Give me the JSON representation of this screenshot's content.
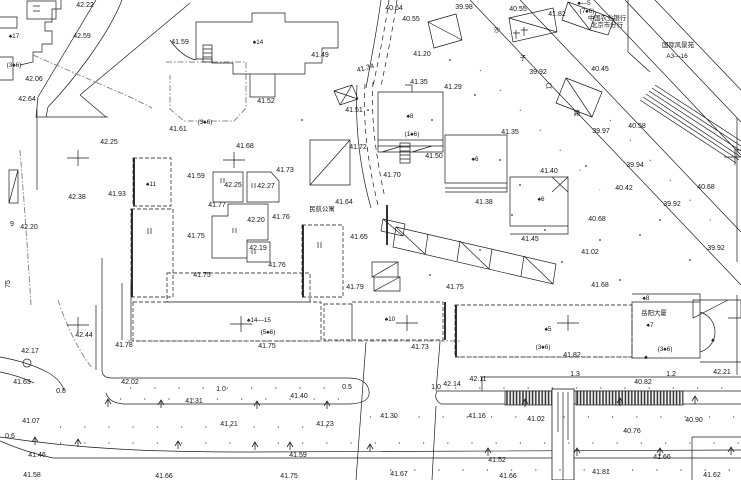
{
  "title": "沙子口路地区地形图 site plan",
  "colors": {
    "line": "#1c1c1c",
    "boundary": "#8a8a8a",
    "text": "#161616",
    "background": "#ffffff"
  },
  "labels": [
    {
      "t": "42.22",
      "x": 85,
      "y": 7,
      "c": "n"
    },
    {
      "t": "42.59",
      "x": 82,
      "y": 38,
      "c": "n"
    },
    {
      "t": "41.59",
      "x": 180,
      "y": 44,
      "c": "n"
    },
    {
      "t": "42.06",
      "x": 34,
      "y": 81,
      "c": "n"
    },
    {
      "t": "42.64",
      "x": 27,
      "y": 101,
      "c": "n"
    },
    {
      "t": "41.49",
      "x": 320,
      "y": 57,
      "c": "n"
    },
    {
      "t": "41.52",
      "x": 266,
      "y": 103,
      "c": "n"
    },
    {
      "t": "41.51",
      "x": 354,
      "y": 112,
      "c": "n"
    },
    {
      "t": "41.61",
      "x": 178,
      "y": 131,
      "c": "n"
    },
    {
      "t": "42.25",
      "x": 109,
      "y": 144,
      "c": "n"
    },
    {
      "t": "42.38",
      "x": 77,
      "y": 199,
      "c": "n"
    },
    {
      "t": "41.93",
      "x": 117,
      "y": 196,
      "c": "n"
    },
    {
      "t": "42.20",
      "x": 29,
      "y": 229,
      "c": "n"
    },
    {
      "t": "42.44",
      "x": 84,
      "y": 337,
      "c": "n"
    },
    {
      "t": "42.17",
      "x": 30,
      "y": 353,
      "c": "n"
    },
    {
      "t": "41.78",
      "x": 124,
      "y": 347,
      "c": "n"
    },
    {
      "t": "41.68",
      "x": 245,
      "y": 148,
      "c": "n"
    },
    {
      "t": "41.59",
      "x": 196,
      "y": 178,
      "c": "n"
    },
    {
      "t": "41.73",
      "x": 285,
      "y": 172,
      "c": "n"
    },
    {
      "t": "42.25",
      "x": 233,
      "y": 187,
      "c": "n"
    },
    {
      "t": "42.27",
      "x": 266,
      "y": 188,
      "c": "n"
    },
    {
      "t": "41.77",
      "x": 217,
      "y": 207,
      "c": "n"
    },
    {
      "t": "42.20",
      "x": 256,
      "y": 222,
      "c": "n"
    },
    {
      "t": "41.76",
      "x": 281,
      "y": 219,
      "c": "n"
    },
    {
      "t": "41.75",
      "x": 196,
      "y": 238,
      "c": "n"
    },
    {
      "t": "42.19",
      "x": 258,
      "y": 250,
      "c": "n"
    },
    {
      "t": "41.76",
      "x": 277,
      "y": 267,
      "c": "n"
    },
    {
      "t": "41.75",
      "x": 202,
      "y": 277,
      "c": "n"
    },
    {
      "t": "41.75",
      "x": 455,
      "y": 289,
      "c": "n"
    },
    {
      "t": "41.79",
      "x": 355,
      "y": 289,
      "c": "n"
    },
    {
      "t": "41.72",
      "x": 358,
      "y": 149,
      "c": "n"
    },
    {
      "t": "41.70",
      "x": 392,
      "y": 177,
      "c": "n"
    },
    {
      "t": "41.50",
      "x": 434,
      "y": 158,
      "c": "n"
    },
    {
      "t": "41.64",
      "x": 344,
      "y": 204,
      "c": "n"
    },
    {
      "t": "41.65",
      "x": 359,
      "y": 239,
      "c": "n"
    },
    {
      "t": "41.35",
      "x": 419,
      "y": 84,
      "c": "n"
    },
    {
      "t": "41.29",
      "x": 453,
      "y": 89,
      "c": "n"
    },
    {
      "t": "41.20",
      "x": 422,
      "y": 56,
      "c": "n"
    },
    {
      "t": "41.34",
      "x": 366,
      "y": 70,
      "c": "n",
      "r": -15
    },
    {
      "t": "40.64",
      "x": 394,
      "y": 10,
      "c": "n"
    },
    {
      "t": "40.55",
      "x": 411,
      "y": 21,
      "c": "n"
    },
    {
      "t": "39.98",
      "x": 464,
      "y": 9,
      "c": "n"
    },
    {
      "t": "40.55",
      "x": 518,
      "y": 11,
      "c": "n"
    },
    {
      "t": "41.82",
      "x": 557,
      "y": 16,
      "c": "n"
    },
    {
      "t": "39.92",
      "x": 538,
      "y": 74,
      "c": "n"
    },
    {
      "t": "40.45",
      "x": 600,
      "y": 71,
      "c": "n"
    },
    {
      "t": "39.94",
      "x": 635,
      "y": 167,
      "c": "n"
    },
    {
      "t": "40.42",
      "x": 624,
      "y": 190,
      "c": "n"
    },
    {
      "t": "40.68",
      "x": 706,
      "y": 189,
      "c": "n"
    },
    {
      "t": "39.92",
      "x": 672,
      "y": 206,
      "c": "n"
    },
    {
      "t": "40.68",
      "x": 597,
      "y": 221,
      "c": "n"
    },
    {
      "t": "39.92",
      "x": 716,
      "y": 250,
      "c": "n"
    },
    {
      "t": "41.02",
      "x": 590,
      "y": 254,
      "c": "n"
    },
    {
      "t": "41.68",
      "x": 600,
      "y": 287,
      "c": "n"
    },
    {
      "t": "40.58",
      "x": 637,
      "y": 128,
      "c": "n"
    },
    {
      "t": "39.97",
      "x": 601,
      "y": 133,
      "c": "n"
    },
    {
      "t": "41.35",
      "x": 510,
      "y": 134,
      "c": "n"
    },
    {
      "t": "41.40",
      "x": 549,
      "y": 173,
      "c": "n"
    },
    {
      "t": "41.38",
      "x": 484,
      "y": 204,
      "c": "n"
    },
    {
      "t": "41.45",
      "x": 530,
      "y": 241,
      "c": "n"
    },
    {
      "t": "41.75",
      "x": 267,
      "y": 348,
      "c": "n"
    },
    {
      "t": "41.73",
      "x": 420,
      "y": 349,
      "c": "n"
    },
    {
      "t": "41.82",
      "x": 572,
      "y": 357,
      "c": "n"
    },
    {
      "t": "42.21",
      "x": 722,
      "y": 374,
      "c": "n"
    },
    {
      "t": "40.82",
      "x": 643,
      "y": 384,
      "c": "n"
    },
    {
      "t": "41.02",
      "x": 536,
      "y": 421,
      "c": "n"
    },
    {
      "t": "40.90",
      "x": 694,
      "y": 422,
      "c": "n"
    },
    {
      "t": "40.76",
      "x": 632,
      "y": 433,
      "c": "n"
    },
    {
      "t": "41.21",
      "x": 229,
      "y": 426,
      "c": "n"
    },
    {
      "t": "41.23",
      "x": 325,
      "y": 426,
      "c": "n"
    },
    {
      "t": "41.31",
      "x": 194,
      "y": 403,
      "c": "n"
    },
    {
      "t": "41.40",
      "x": 299,
      "y": 398,
      "c": "n"
    },
    {
      "t": "42.02",
      "x": 130,
      "y": 384,
      "c": "n"
    },
    {
      "t": "42.14",
      "x": 452,
      "y": 386,
      "c": "n"
    },
    {
      "t": "42.11",
      "x": 478,
      "y": 381,
      "c": "n"
    },
    {
      "t": "41.30",
      "x": 389,
      "y": 418,
      "c": "n"
    },
    {
      "t": "41.16",
      "x": 477,
      "y": 418,
      "c": "n"
    },
    {
      "t": "41.63",
      "x": 22,
      "y": 384,
      "c": "n"
    },
    {
      "t": "41.07",
      "x": 31,
      "y": 423,
      "c": "n"
    },
    {
      "t": "41.46",
      "x": 37,
      "y": 457,
      "c": "n"
    },
    {
      "t": "41.59",
      "x": 298,
      "y": 457,
      "c": "n"
    },
    {
      "t": "41.66",
      "x": 662,
      "y": 459,
      "c": "n"
    },
    {
      "t": "41.52",
      "x": 497,
      "y": 462,
      "c": "n"
    },
    {
      "t": "41.58",
      "x": 32,
      "y": 477,
      "c": "n"
    },
    {
      "t": "41.66",
      "x": 164,
      "y": 478,
      "c": "n"
    },
    {
      "t": "41.75",
      "x": 289,
      "y": 478,
      "c": "n"
    },
    {
      "t": "41.67",
      "x": 399,
      "y": 476,
      "c": "n"
    },
    {
      "t": "41.66",
      "x": 508,
      "y": 478,
      "c": "n"
    },
    {
      "t": "41.81",
      "x": 601,
      "y": 474,
      "c": "n"
    },
    {
      "t": "41.62",
      "x": 712,
      "y": 477,
      "c": "n"
    },
    {
      "t": "0.8",
      "x": 61,
      "y": 393,
      "c": "n"
    },
    {
      "t": "1.0",
      "x": 221,
      "y": 391,
      "c": "n"
    },
    {
      "t": "0.5",
      "x": 347,
      "y": 389,
      "c": "n"
    },
    {
      "t": "1.0",
      "x": 436,
      "y": 389,
      "c": "n"
    },
    {
      "t": "1.3",
      "x": 575,
      "y": 376,
      "c": "n"
    },
    {
      "t": "1.2",
      "x": 671,
      "y": 376,
      "c": "n"
    },
    {
      "t": "9",
      "x": 12,
      "y": 226,
      "c": "n"
    },
    {
      "t": "75",
      "x": 10,
      "y": 284,
      "c": "n",
      "r": -90
    },
    {
      "t": "0.6",
      "x": 10,
      "y": 438,
      "c": "n"
    },
    {
      "t": "♠17",
      "x": 14,
      "y": 38,
      "c": "g"
    },
    {
      "t": "(3♠6)",
      "x": 14,
      "y": 67,
      "c": "g"
    },
    {
      "t": "♠14",
      "x": 258,
      "y": 44,
      "c": "g"
    },
    {
      "t": "(3♠6)",
      "x": 205,
      "y": 124,
      "c": "g"
    },
    {
      "t": "♠11",
      "x": 151,
      "y": 186,
      "c": "g"
    },
    {
      "t": "♠8",
      "x": 410,
      "y": 118,
      "c": "g"
    },
    {
      "t": "(1♠6)",
      "x": 412,
      "y": 136,
      "c": "g"
    },
    {
      "t": "♠6",
      "x": 475,
      "y": 161,
      "c": "g"
    },
    {
      "t": "♠6",
      "x": 541,
      "y": 201,
      "c": "g"
    },
    {
      "t": "♠—5",
      "x": 584,
      "y": 5,
      "c": "g"
    },
    {
      "t": "(7♠6)",
      "x": 587,
      "y": 13,
      "c": "g"
    },
    {
      "t": "♠14—15",
      "x": 259,
      "y": 322,
      "c": "g"
    },
    {
      "t": "(5♠6)",
      "x": 268,
      "y": 334,
      "c": "g"
    },
    {
      "t": "♠10",
      "x": 390,
      "y": 321,
      "c": "g"
    },
    {
      "t": "♠5",
      "x": 548,
      "y": 331,
      "c": "g"
    },
    {
      "t": "(3♠6)",
      "x": 543,
      "y": 349,
      "c": "g"
    },
    {
      "t": "(3♠6)",
      "x": 665,
      "y": 351,
      "c": "g"
    },
    {
      "t": "♠8",
      "x": 646,
      "y": 300,
      "c": "g"
    },
    {
      "t": "♠7",
      "x": 650,
      "y": 327,
      "c": "g"
    },
    {
      "t": "♠",
      "x": 646,
      "y": 359,
      "c": "g"
    },
    {
      "t": "♠",
      "x": 713,
      "y": 342,
      "c": "g"
    },
    {
      "t": "中国农业银行",
      "x": 607,
      "y": 20,
      "c": "cn"
    },
    {
      "t": "北京市分行",
      "x": 607,
      "y": 27,
      "c": "cn"
    },
    {
      "t": "国际风景苑",
      "x": 678,
      "y": 47,
      "c": "cn"
    },
    {
      "t": "A3—16",
      "x": 677,
      "y": 58,
      "c": "cn"
    },
    {
      "t": "沙",
      "x": 497,
      "y": 32,
      "c": "cn"
    },
    {
      "t": "子",
      "x": 523,
      "y": 60,
      "c": "cn"
    },
    {
      "t": "口",
      "x": 549,
      "y": 88,
      "c": "cn"
    },
    {
      "t": "路",
      "x": 577,
      "y": 115,
      "c": "cn"
    },
    {
      "t": "民航公寓",
      "x": 322,
      "y": 211,
      "c": "cn"
    },
    {
      "t": "岳阳大厦",
      "x": 654,
      "y": 315,
      "c": "cn"
    }
  ],
  "markers": {
    "crosses": [
      {
        "x": 78,
        "y": 158
      },
      {
        "x": 234,
        "y": 160
      },
      {
        "x": 735,
        "y": 157
      },
      {
        "x": 78,
        "y": 325
      },
      {
        "x": 241,
        "y": 324
      },
      {
        "x": 407,
        "y": 323
      },
      {
        "x": 568,
        "y": 323
      }
    ],
    "trees": [
      {
        "x": 108,
        "y": 403
      },
      {
        "x": 161,
        "y": 404
      },
      {
        "x": 257,
        "y": 405
      },
      {
        "x": 327,
        "y": 405
      },
      {
        "x": 525,
        "y": 403
      },
      {
        "x": 620,
        "y": 402
      },
      {
        "x": 695,
        "y": 400
      },
      {
        "x": 35,
        "y": 441
      },
      {
        "x": 78,
        "y": 443
      },
      {
        "x": 178,
        "y": 445
      },
      {
        "x": 255,
        "y": 446
      },
      {
        "x": 290,
        "y": 446
      },
      {
        "x": 370,
        "y": 448
      },
      {
        "x": 488,
        "y": 452
      },
      {
        "x": 577,
        "y": 452
      },
      {
        "x": 660,
        "y": 452
      },
      {
        "x": 731,
        "y": 451
      }
    ],
    "dots": [
      {
        "x": 450,
        "y": 60
      },
      {
        "x": 475,
        "y": 95
      },
      {
        "x": 432,
        "y": 120
      },
      {
        "x": 500,
        "y": 160
      },
      {
        "x": 520,
        "y": 185
      },
      {
        "x": 545,
        "y": 230
      },
      {
        "x": 600,
        "y": 240
      },
      {
        "x": 660,
        "y": 220
      },
      {
        "x": 690,
        "y": 260
      },
      {
        "x": 620,
        "y": 280
      },
      {
        "x": 368,
        "y": 110
      },
      {
        "x": 302,
        "y": 120
      },
      {
        "x": 480,
        "y": 250
      },
      {
        "x": 430,
        "y": 275
      },
      {
        "x": 562,
        "y": 262
      },
      {
        "x": 586,
        "y": 166
      },
      {
        "x": 512,
        "y": 215
      },
      {
        "x": 640,
        "y": 235
      }
    ]
  }
}
